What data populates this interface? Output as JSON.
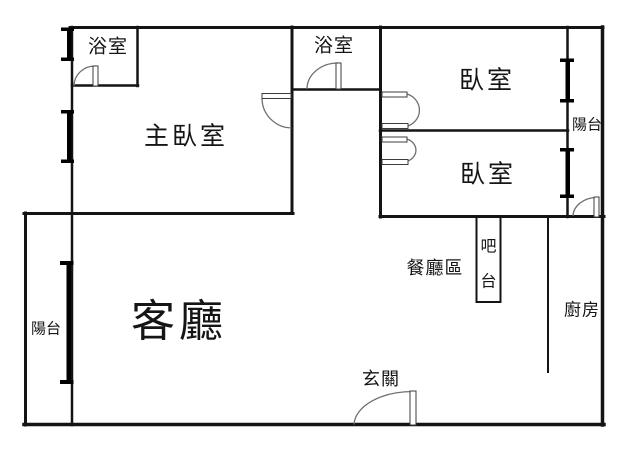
{
  "plan_title": "apartment-floor-plan",
  "rooms": {
    "bathroom_left": {
      "label": "浴室"
    },
    "bathroom_middle": {
      "label": "浴室"
    },
    "master_bedroom": {
      "label": "主臥室"
    },
    "bedroom_top": {
      "label": "臥室"
    },
    "bedroom_bottom": {
      "label": "臥室"
    },
    "balcony_right": {
      "label": "陽台"
    },
    "balcony_left": {
      "label": "陽台"
    },
    "living_room": {
      "label": "客廳"
    },
    "dining_area": {
      "label": "餐廳區"
    },
    "bar_counter": {
      "label": "吧台",
      "chars": [
        "吧",
        "台"
      ]
    },
    "kitchen": {
      "label": "廚房"
    },
    "entrance": {
      "label": "玄關"
    }
  },
  "colors": {
    "background": "#ffffff",
    "wall": "#141414",
    "window": "#000000",
    "door_arc": "#6f6f6f",
    "door_leaf_border": "#3c3c3c",
    "text": "#151515"
  }
}
